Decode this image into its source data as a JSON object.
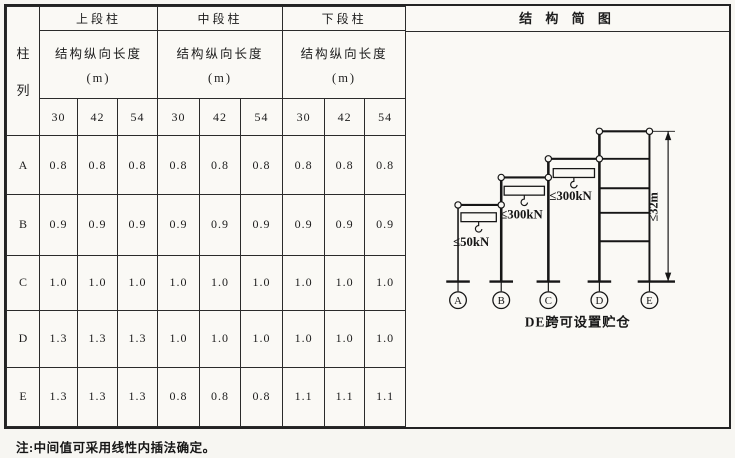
{
  "table": {
    "corner": [
      "柱",
      "列"
    ],
    "groups": [
      {
        "title": "上段柱"
      },
      {
        "title": "中段柱"
      },
      {
        "title": "下段柱"
      }
    ],
    "length_label": "结构纵向长度",
    "length_unit": "(m)",
    "span_headers": [
      "30",
      "42",
      "54"
    ],
    "rows": [
      {
        "label": "A",
        "values": [
          "0.8",
          "0.8",
          "0.8",
          "0.8",
          "0.8",
          "0.8",
          "0.8",
          "0.8",
          "0.8"
        ]
      },
      {
        "label": "B",
        "values": [
          "0.9",
          "0.9",
          "0.9",
          "0.9",
          "0.9",
          "0.9",
          "0.9",
          "0.9",
          "0.9"
        ]
      },
      {
        "label": "C",
        "values": [
          "1.0",
          "1.0",
          "1.0",
          "1.0",
          "1.0",
          "1.0",
          "1.0",
          "1.0",
          "1.0"
        ]
      },
      {
        "label": "D",
        "values": [
          "1.3",
          "1.3",
          "1.3",
          "1.0",
          "1.0",
          "1.0",
          "1.0",
          "1.0",
          "1.0"
        ]
      },
      {
        "label": "E",
        "values": [
          "1.3",
          "1.3",
          "1.3",
          "0.8",
          "0.8",
          "0.8",
          "1.1",
          "1.1",
          "1.1"
        ]
      }
    ]
  },
  "diagram": {
    "title": "结 构 简 图",
    "caption": "DE跨可设置贮仓",
    "height_label": "≤32m",
    "cranes": [
      {
        "label": "≤50kN"
      },
      {
        "label": "≤300kN"
      },
      {
        "label": "≤300kN"
      }
    ],
    "column_labels": [
      "A",
      "B",
      "C",
      "D",
      "E"
    ]
  },
  "note": "注:中间值可采用线性内插法确定。"
}
